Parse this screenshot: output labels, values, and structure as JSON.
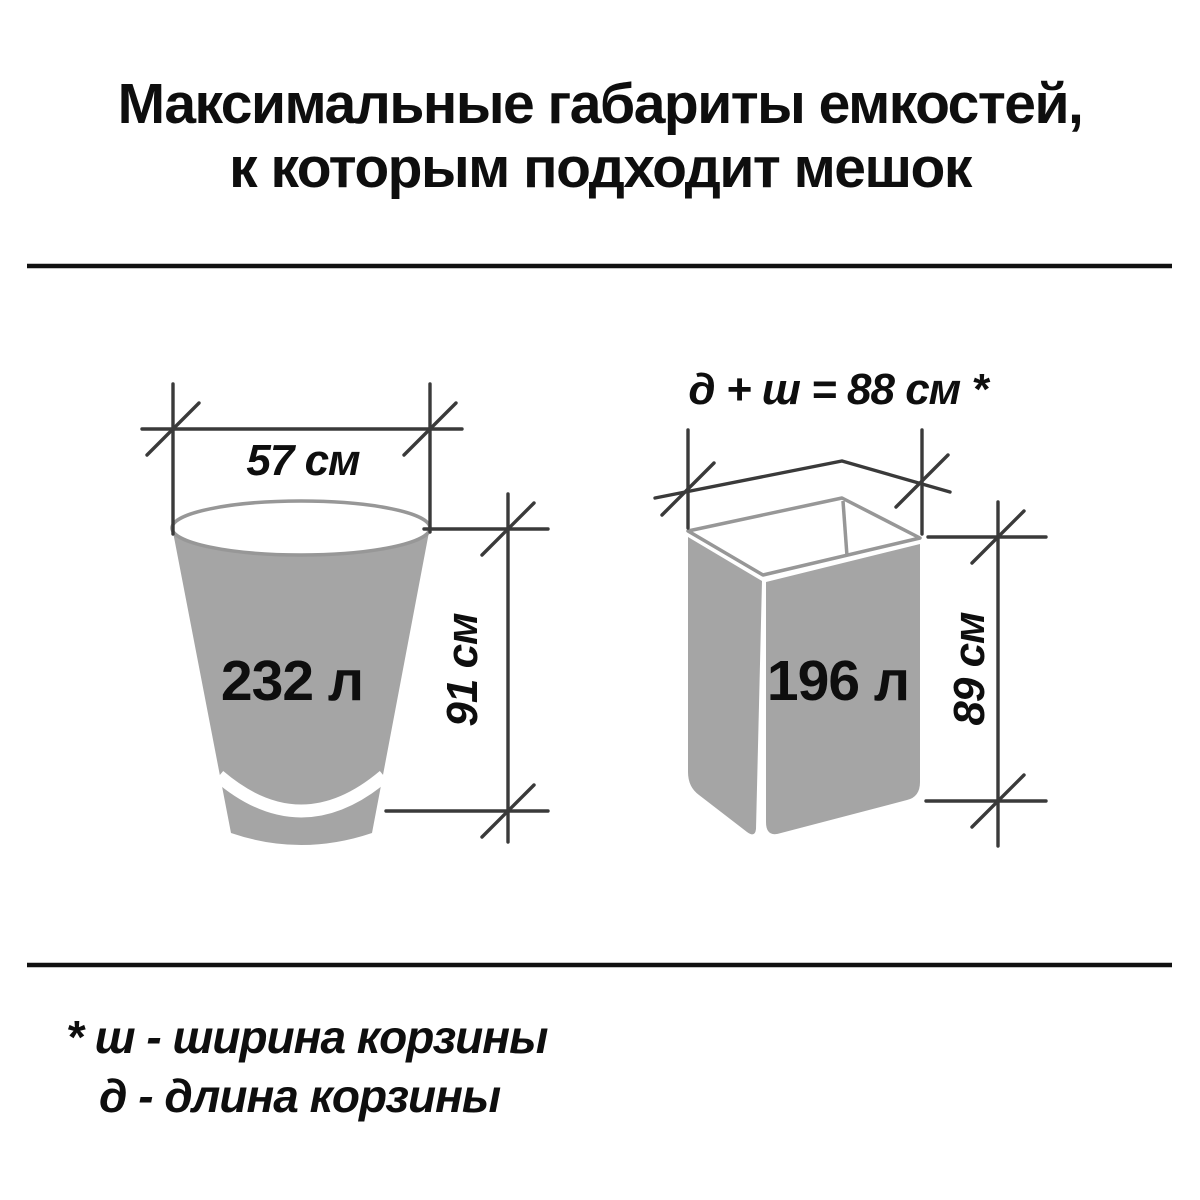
{
  "title": {
    "line1": "Максимальные габариты емкостей,",
    "line2": "к которым подходит мешок"
  },
  "figures": {
    "bucket": {
      "volume": "232 л",
      "width_label": "57 см",
      "height_label": "91 см"
    },
    "basket": {
      "volume": "196 л",
      "top_label": "д + ш = 88 см *",
      "height_label": "89 см"
    }
  },
  "footnote": {
    "line1": "* ш - ширина корзины",
    "line2": "д - длина корзины"
  },
  "colors": {
    "fill_gray": "#a5a5a5",
    "outline_gray": "#979797",
    "line_dark": "#3a3a3a",
    "divider": "#111111",
    "text": "#0e0e0e"
  }
}
